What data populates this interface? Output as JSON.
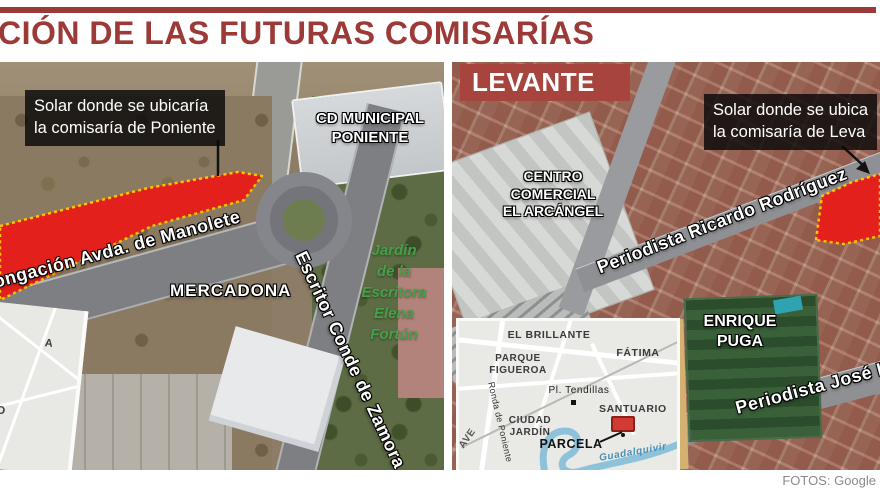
{
  "page": {
    "title": "CIÓN DE LAS FUTURAS COMISARÍAS",
    "credit": "FOTOS: Google"
  },
  "colors": {
    "title_red": "#9c3a37",
    "header_red": "#a6443d",
    "parcel_red": "#e3201b",
    "parcel_border_yellow": "#ffc400",
    "river_blue": "#8ec2da",
    "callout_bg": "rgba(8,8,8,0.82)"
  },
  "left_panel": {
    "callout_lines": [
      "Solar donde se ubicaría",
      "la comisaría de Poniente"
    ],
    "stadium_lines": [
      "CD MUNICIPAL",
      "PONIENTE"
    ],
    "street_manolete": "ongación Avda. de Manolete",
    "supermarket": "MERCADONA",
    "street_zamora": "Escritor Conde de Zamora",
    "park_lines": [
      "Jardín",
      "de la",
      "Escritora",
      "Elena",
      "Fortún"
    ],
    "inset_fragment_labels": [
      "A",
      "RIO"
    ]
  },
  "right_panel": {
    "header": "LEVANTE",
    "callout_lines": [
      "Solar donde se ubica",
      "la comisaría de Leva"
    ],
    "mall_lines": [
      "CENTRO",
      "COMERCIAL",
      "EL ARCÁNGEL"
    ],
    "street_rodriguez": "Periodista Ricardo Rodríguez",
    "pitch_lines": [
      "ENRIQUE",
      "PUGA"
    ],
    "street_jose": "Periodista José L",
    "inset_map": {
      "district_1": "EL BRILLANTE",
      "district_2": "FÁTIMA",
      "park_lines": [
        "PARQUE",
        "FIGUEROA"
      ],
      "plaza": "Pl. Tendillas",
      "santuario": "SANTUARIO",
      "ciudad_lines": [
        "CIUDAD",
        "JARDÍN"
      ],
      "parcela": "PARCELA",
      "ave": "AVE",
      "ronda": "Ronda de Poniente",
      "river": "Guadalquivir"
    }
  }
}
